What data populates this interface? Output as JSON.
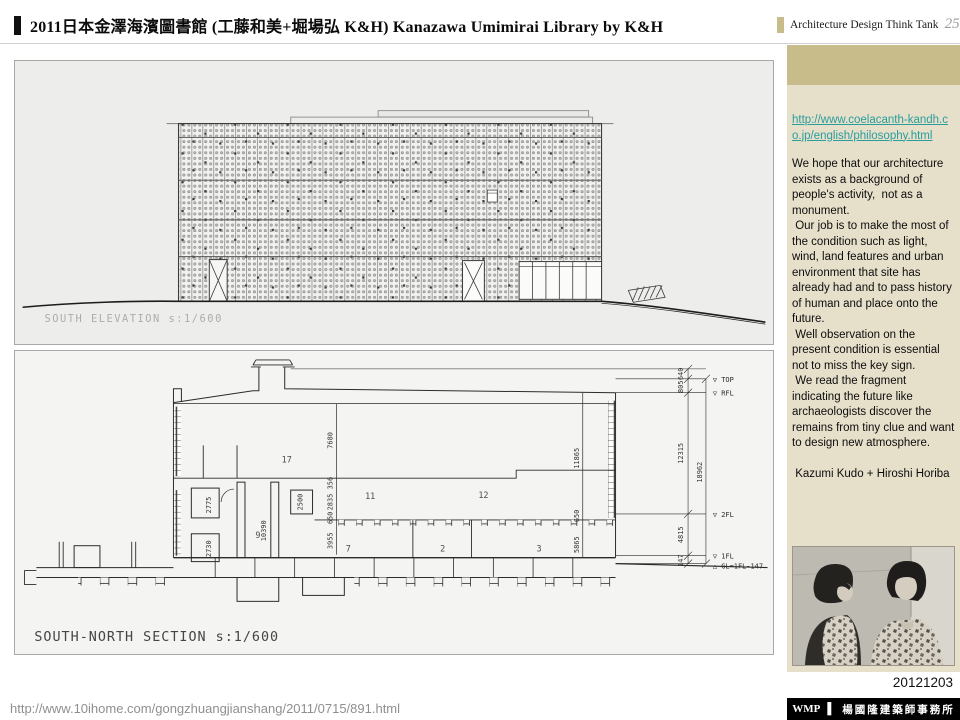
{
  "header": {
    "title": "2011日本金澤海濱圖書館 (工藤和美+堀場弘 K&H) Kanazawa Umimirai Library by K&H",
    "brand": "Architecture Design Think Tank",
    "page_number": "25"
  },
  "sidebar": {
    "link_text": "http://www.coelacanth-kandh.co.jp/english/philosophy.html",
    "paragraphs": [
      "We hope that our architecture exists as a background of people's activity,  not as a monument.",
      " Our job is to make the most of the condition such as light, wind, land features and urban environment that site has already had and to pass history of human and place onto the future.",
      " Well observation on the present condition is essential  not to miss the key sign.",
      " We read the fragment indicating the future like archaeologists discover the remains from tiny clue and want to design new atmosphere."
    ],
    "credit": " Kazumi Kudo + Hiroshi Horiba",
    "date": "20121203"
  },
  "drawings": {
    "elevation": {
      "label": "SOUTH ELEVATION s:1/600"
    },
    "section": {
      "label": "SOUTH-NORTH SECTION s:1/600",
      "rooms": [
        "17",
        "11",
        "12",
        "9",
        "7",
        "2",
        "3"
      ],
      "left_dims": [
        "2775",
        "2730"
      ],
      "shaft_dims": [
        "10390",
        "2500"
      ],
      "center_dims": [
        "7680",
        "356",
        "2835",
        "650",
        "3955"
      ],
      "right_inner_dims": [
        "11865",
        "650",
        "5865"
      ],
      "outer_dims": [
        "640",
        "805",
        "12315",
        "4815",
        "147"
      ],
      "total_dim": "18962",
      "levels": [
        "▽ TOP",
        "▽ RFL",
        "▽ 2FL",
        "▽ 1FL",
        "△ GL=1FL-147"
      ]
    }
  },
  "footer": {
    "source_url": "http://www.10ihome.com/gongzhuangjianshang/2011/0715/891.html",
    "brand": "WMP",
    "separator": "▌",
    "office": "楊國隆建築師事務所"
  },
  "colors": {
    "accent_tan": "#c8bc8b",
    "sidebar_bg": "#e6dfca",
    "link_teal": "#2a9d9d",
    "footer_bar": "#000000"
  }
}
